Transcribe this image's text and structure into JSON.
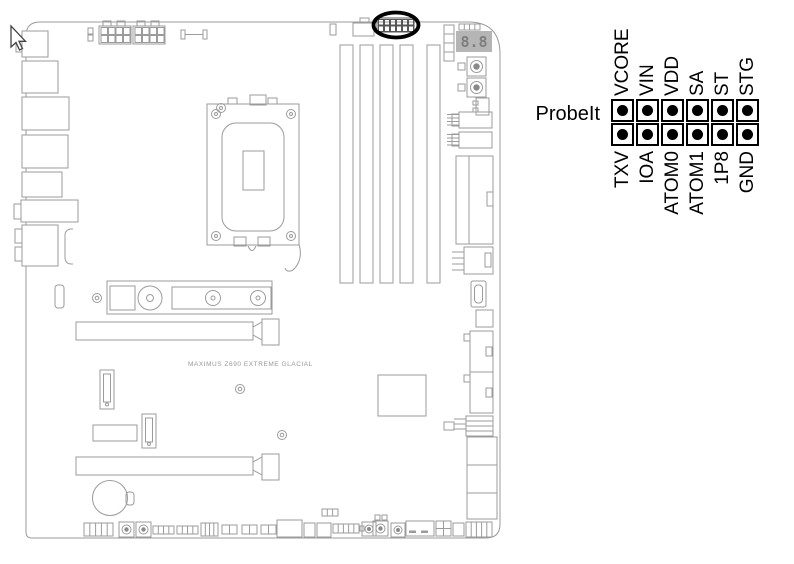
{
  "board": {
    "name_text": "MAXIMUS Z690 EXTREME GLACIAL",
    "qcode_text": "8.8",
    "line_color": "#9b9b9b"
  },
  "legend": {
    "label": "ProbeIt",
    "top_pins": [
      "VCORE",
      "VIN",
      "VDD",
      "SA",
      "ST",
      "STG"
    ],
    "bottom_pins": [
      "TXV",
      "IOA",
      "ATOM0",
      "ATOM1",
      "1P8",
      "GND"
    ],
    "pin_rows": 2,
    "pin_cols": 6,
    "highlight_color": "#000000"
  }
}
